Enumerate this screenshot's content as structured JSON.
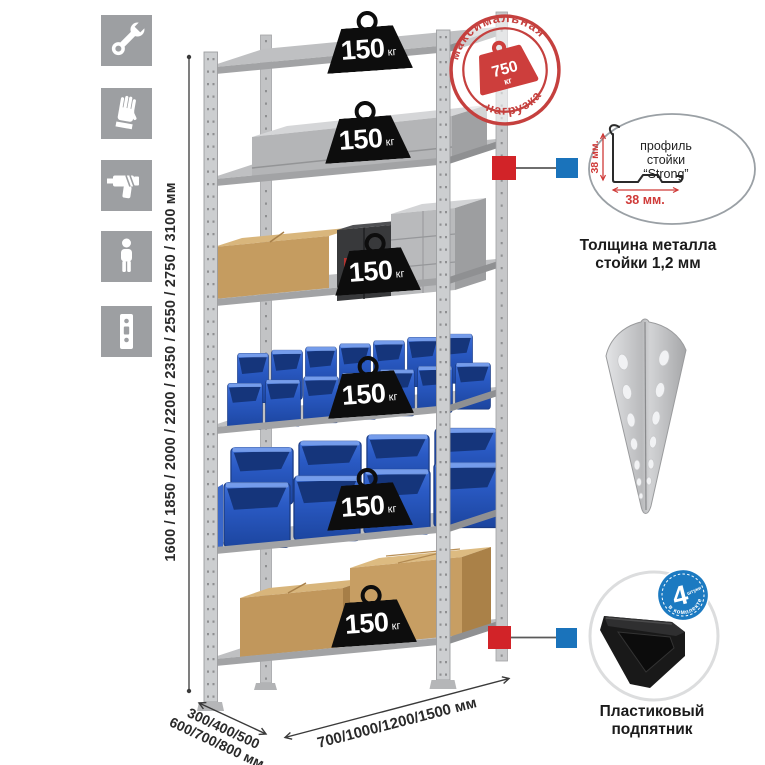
{
  "sidebar": {
    "icons": [
      {
        "name": "wrench"
      },
      {
        "name": "gloves"
      },
      {
        "name": "drill"
      },
      {
        "name": "person"
      },
      {
        "name": "rack-post-profile"
      }
    ]
  },
  "shelf_loads": [
    {
      "value": "150",
      "unit": "кг"
    },
    {
      "value": "150",
      "unit": "кг"
    },
    {
      "value": "150",
      "unit": "кг"
    },
    {
      "value": "150",
      "unit": "кг"
    },
    {
      "value": "150",
      "unit": "кг"
    },
    {
      "value": "150",
      "unit": "кг"
    }
  ],
  "load_badge": {
    "arc_top": "максимальная",
    "arc_bottom": "нагрузка",
    "value": "750",
    "unit": "кг"
  },
  "dimensions": {
    "height": "1600 / 1850 / 2000 / 2200 / 2350 / 2550 / 2750 / 3100 мм",
    "depth_line1": "300/400/500",
    "depth_line2": "600/700/800 мм",
    "width": "700/1000/1200/1500 мм"
  },
  "profile_detail": {
    "line1": "профиль",
    "line2": "стойки",
    "line3": "“Strong”",
    "dim_vertical": "38 мм.",
    "dim_horizontal": "38 мм.",
    "caption1": "Толщина металла",
    "caption2": "стойки 1,2 мм"
  },
  "foot_detail": {
    "badge_value": "4",
    "badge_unit": "штуки",
    "badge_arc": "в комплекте",
    "caption1": "Пластиковый",
    "caption2": "подпятник"
  },
  "colors": {
    "stamp_red": "#c5403e",
    "marker_red": "#d22328",
    "marker_blue": "#1a73bb",
    "bin_blue": "#2a5ac4",
    "metal_gray": "#c7c8ca",
    "icon_gray": "#9d9fa2"
  }
}
